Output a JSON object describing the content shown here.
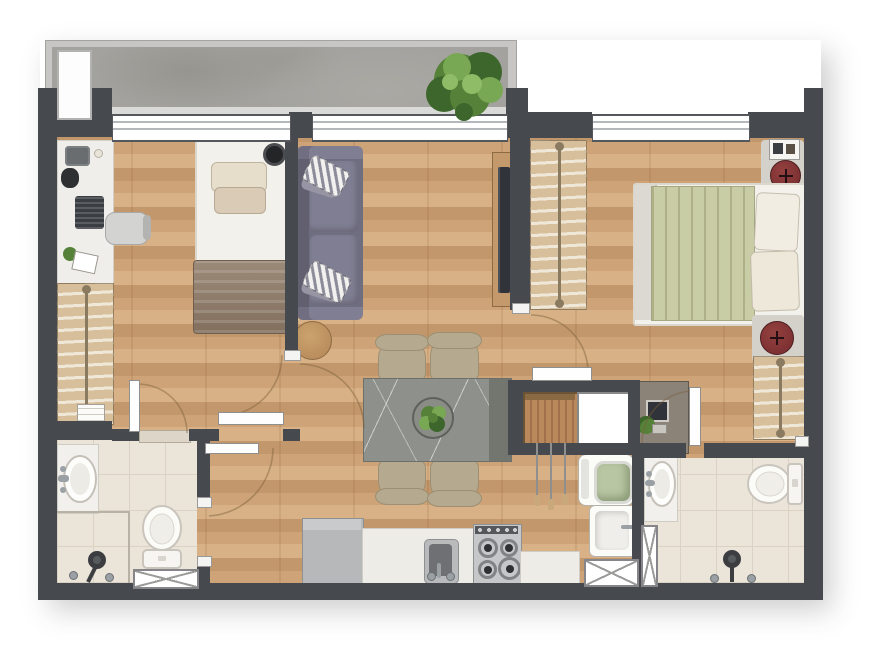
{
  "image_type": "rendered apartment floor plan, top-down view, no text labels",
  "colors": {
    "bg": "#ffffff",
    "wall": "#46494d",
    "parapet": "#c7c6c4",
    "sill": "#dadad8",
    "concrete": "#a3a29e",
    "concrete_dark": "#96958f",
    "window_frame": "#54575b",
    "window_line": "#b4b8bc",
    "wood_a": "#cda377",
    "wood_b": "#c2976b",
    "wood_c": "#d8b186",
    "wood_seam": "rgba(110,60,20,0.10)",
    "tile": "#ebe4d8",
    "tile_line": "#dbd2c4",
    "fixture": "#fafaf7",
    "fixture_shadow": "#ccc8c0",
    "counter": "#eeece7",
    "fridge": "#b7b8ba",
    "fridge_top": "#c9cacc",
    "stove": "#c6c7c9",
    "stove_panel": "#54575b",
    "burner": "#808285",
    "burner_dark": "#2e3033",
    "sink_outer": "#b9babc",
    "sink_inner": "#6e7073",
    "metal": "#9aa0a4",
    "sofa": "#6f6d80",
    "sofa_hi": "#807e92",
    "stripe_light": "#f2f1ef",
    "stripe_dark": "#8c8b99",
    "sheet": "#f3f1ec",
    "pillow_cream": "#e7ddcb",
    "pillow_beige": "#d9cbb6",
    "bed1_blanket_a": "#9c8a79",
    "bed1_blanket_b": "#826f5d",
    "bed2_blanket": "#c9cda6",
    "bed2_crease": "#aeb188",
    "wardrobe_bg": "#d7bf9b",
    "rod": "#8a7a5f",
    "hanger": "#efe8d8",
    "wood_furn": "#c49a6c",
    "tv": "#30343a",
    "table": "#8e918b",
    "table_dark": "#73766e",
    "vein": "rgba(255,255,255,0.55)",
    "chair": "#b5a98f",
    "chair_dark": "#9c8f74",
    "side_table": "#b98d5c",
    "pouf": "#7e3133",
    "pouf_hi": "#94403f",
    "mat": "#d4d1cb",
    "plant_dark": "#3c662c",
    "plant_mid": "#558238",
    "plant_light": "#79a854",
    "washer_glass": "#b9c6a4",
    "leaf": "#fefefe",
    "leaf_border": "#8f8f8d",
    "arc": "rgba(125,95,60,0.45)",
    "hatch": "#9b9b99",
    "slat_a": "#b9895c",
    "slat_b": "#a0714a",
    "skewer": "#c9a97c",
    "desk2": "#8b8278"
  },
  "scene": {
    "type": "floor-plan",
    "windows_count": 3,
    "vents_count": 3,
    "doors": [
      "bedroom-1",
      "bedroom-2",
      "bathroom-1",
      "bathroom-2",
      "hall"
    ],
    "rooms": [
      {
        "name": "balcony",
        "floor": "concrete",
        "items": [
          "shrub-plant",
          "ac-units-box",
          "parapet"
        ]
      },
      {
        "name": "bedroom-1",
        "floor": "wood",
        "items": [
          "single-bed",
          "headboard-pillows",
          "taupe-blanket",
          "pendant-lamp",
          "desk-counter",
          "coffee-machine",
          "kettle",
          "laptop",
          "notepad",
          "office-chair",
          "wardrobe-with-hangers",
          "low-dresser"
        ]
      },
      {
        "name": "living-dining",
        "floor": "wood",
        "items": [
          "two-seat-sofa",
          "striped-pillows",
          "round-side-table",
          "tv-sideboard",
          "dining-table-marble",
          "dark-end-panel",
          "centerpiece-plant",
          "dining-chairs-x4"
        ]
      },
      {
        "name": "bedroom-2",
        "floor": "wood",
        "items": [
          "double-bed-sage",
          "pillows",
          "wardrobe-with-hangers-left",
          "wardrobe-with-hangers-right",
          "wall-shelf-frames",
          "round-pouf-top",
          "round-pouf-bottom",
          "gray-mats",
          "work-desk",
          "monitor",
          "desk-plant"
        ]
      },
      {
        "name": "grill-niche",
        "items": [
          "wood-slat-panel",
          "hanging-skewers",
          "white-shaft"
        ]
      },
      {
        "name": "kitchen",
        "floor": "wood",
        "items": [
          "refrigerator",
          "counter-with-sink",
          "faucet",
          "gas-stove-4-burners",
          "side-counter"
        ]
      },
      {
        "name": "laundry",
        "items": [
          "top-view-washer",
          "laundry-tank",
          "wall-vent"
        ]
      },
      {
        "name": "bathroom-1",
        "floor": "tile",
        "items": [
          "counter-sink",
          "toilet",
          "shower-head",
          "shower-partition-lines",
          "wall-vent",
          "knobs"
        ]
      },
      {
        "name": "bathroom-2",
        "floor": "tile",
        "items": [
          "counter-sink",
          "toilet",
          "shower-head",
          "duct-vent",
          "knobs"
        ]
      }
    ]
  }
}
